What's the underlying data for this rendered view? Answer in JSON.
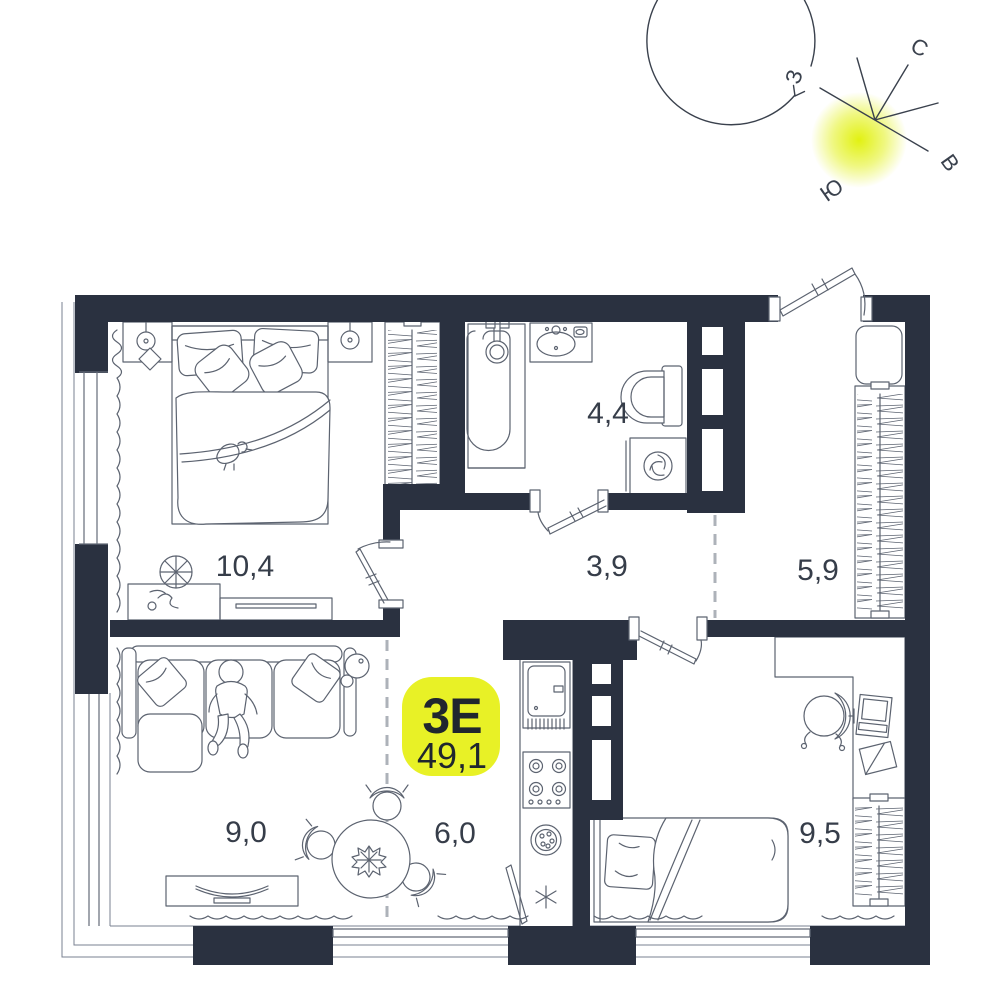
{
  "badge": {
    "type_label": "3Е",
    "area_value": "49,1"
  },
  "room_areas": {
    "bedroom_main": "10,4",
    "bathroom": "4,4",
    "hallway": "3,9",
    "entry_hall": "5,9",
    "living_room": "9,0",
    "kitchen": "6,0",
    "bedroom_second": "9,5"
  },
  "compass": {
    "north": "С",
    "south": "Ю",
    "west": "З",
    "east": "В"
  },
  "colors": {
    "wall": "#2A3140",
    "furniture_line": "#5C6370",
    "label_text": "#363D49",
    "accent_badge": "#E8F126",
    "badge_text": "#20262E",
    "dashed_line": "#ADB2B9",
    "sun_glow": "#E0F005"
  }
}
